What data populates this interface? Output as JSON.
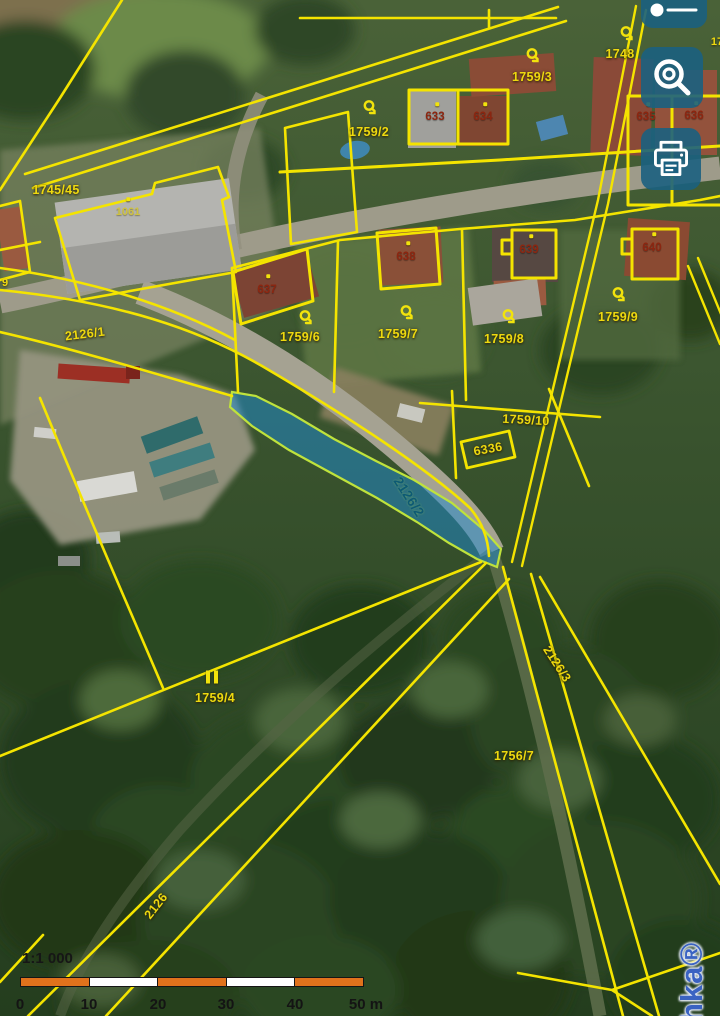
{
  "watermark": {
    "text": "hka®"
  },
  "controls": {
    "buttons": [
      {
        "name": "zoom-slider",
        "icon": "slider-icon"
      },
      {
        "name": "search",
        "icon": "magnifier-icon"
      },
      {
        "name": "print",
        "icon": "printer-icon"
      }
    ]
  },
  "scalebar": {
    "ratio": "1:1 000",
    "segment_colors": [
      "#e0721c",
      "#ffffff",
      "#e0721c",
      "#ffffff",
      "#e0721c"
    ],
    "ticks": [
      {
        "t": "0",
        "x": 6
      },
      {
        "t": "10",
        "x": 75
      },
      {
        "t": "20",
        "x": 144
      },
      {
        "t": "30",
        "x": 212
      },
      {
        "t": "40",
        "x": 281
      },
      {
        "t": "50 m",
        "x": 352
      }
    ]
  },
  "map": {
    "selected_parcel": {
      "id": "2126/2",
      "fill": "#1e8acd",
      "stroke": "#bfe23c"
    },
    "colors": {
      "boundary_yellow": "#f4e400",
      "parcel_label": "#eed90f",
      "building_label": "#8c2610",
      "selected_label": "#0d5a74",
      "button_blue": "#1b6080",
      "scalebar_orange": "#e0721c"
    },
    "labels": [
      {
        "t": "1745/45",
        "x": 56,
        "y": 190,
        "r": 0,
        "c": "parcel"
      },
      {
        "t": "1759/2",
        "x": 369,
        "y": 132,
        "r": 0,
        "c": "parcel"
      },
      {
        "t": "1759/3",
        "x": 532,
        "y": 77,
        "r": 0,
        "c": "parcel"
      },
      {
        "t": "1748",
        "x": 620,
        "y": 54,
        "r": 0,
        "c": "parcel"
      },
      {
        "t": "17",
        "x": 717,
        "y": 42,
        "r": 0,
        "c": "frag"
      },
      {
        "t": "1759/6",
        "x": 300,
        "y": 337,
        "r": 0,
        "c": "parcel"
      },
      {
        "t": "1759/7",
        "x": 398,
        "y": 334,
        "r": 0,
        "c": "parcel"
      },
      {
        "t": "1759/8",
        "x": 504,
        "y": 339,
        "r": 0,
        "c": "parcel"
      },
      {
        "t": "1759/9",
        "x": 618,
        "y": 317,
        "r": 0,
        "c": "parcel"
      },
      {
        "t": "1759/10",
        "x": 526,
        "y": 420,
        "r": 3,
        "c": "parcel"
      },
      {
        "t": "6336",
        "x": 488,
        "y": 449,
        "r": -10,
        "c": "parcel"
      },
      {
        "t": "2126/1",
        "x": 85,
        "y": 334,
        "r": -7,
        "c": "parcel"
      },
      {
        "t": "9",
        "x": 5,
        "y": 283,
        "r": 0,
        "c": "frag"
      },
      {
        "t": "2126/2",
        "x": 409,
        "y": 497,
        "r": 57,
        "c": "selected"
      },
      {
        "t": "2126/3",
        "x": 557,
        "y": 664,
        "r": 57,
        "c": "parcel"
      },
      {
        "t": "1759/4",
        "x": 215,
        "y": 698,
        "r": 0,
        "c": "parcel"
      },
      {
        "t": "1756/7",
        "x": 514,
        "y": 756,
        "r": 0,
        "c": "parcel"
      },
      {
        "t": "2126",
        "x": 156,
        "y": 906,
        "r": -52,
        "c": "parcel"
      },
      {
        "t": "1061",
        "x": 128,
        "y": 212,
        "r": 0,
        "c": "bldgy"
      },
      {
        "t": "633",
        "x": 435,
        "y": 117,
        "r": 0,
        "c": "building"
      },
      {
        "t": "634",
        "x": 483,
        "y": 117,
        "r": 0,
        "c": "building"
      },
      {
        "t": "635",
        "x": 646,
        "y": 117,
        "r": 0,
        "c": "building"
      },
      {
        "t": "636",
        "x": 694,
        "y": 116,
        "r": 0,
        "c": "building"
      },
      {
        "t": "637",
        "x": 267,
        "y": 290,
        "r": 0,
        "c": "building"
      },
      {
        "t": "638",
        "x": 406,
        "y": 257,
        "r": 0,
        "c": "building"
      },
      {
        "t": "639",
        "x": 529,
        "y": 250,
        "r": 0,
        "c": "building"
      },
      {
        "t": "640",
        "x": 652,
        "y": 248,
        "r": 0,
        "c": "building"
      }
    ],
    "symbols": [
      {
        "k": "lock",
        "x": 370,
        "y": 110
      },
      {
        "k": "lock",
        "x": 533,
        "y": 58
      },
      {
        "k": "lock",
        "x": 627,
        "y": 36
      },
      {
        "k": "lock",
        "x": 306,
        "y": 320
      },
      {
        "k": "lock",
        "x": 407,
        "y": 315
      },
      {
        "k": "lock",
        "x": 509,
        "y": 319
      },
      {
        "k": "lock",
        "x": 619,
        "y": 297
      },
      {
        "k": "dot",
        "x": 437,
        "y": 104
      },
      {
        "k": "dot",
        "x": 485,
        "y": 104
      },
      {
        "k": "dot",
        "x": 648,
        "y": 104
      },
      {
        "k": "dot",
        "x": 696,
        "y": 103
      },
      {
        "k": "dot",
        "x": 268,
        "y": 276
      },
      {
        "k": "dot",
        "x": 408,
        "y": 243
      },
      {
        "k": "dot",
        "x": 531,
        "y": 236
      },
      {
        "k": "dot",
        "x": 654,
        "y": 234
      },
      {
        "k": "dot",
        "x": 128,
        "y": 199
      },
      {
        "k": "bars",
        "x": 212,
        "y": 677
      }
    ]
  }
}
